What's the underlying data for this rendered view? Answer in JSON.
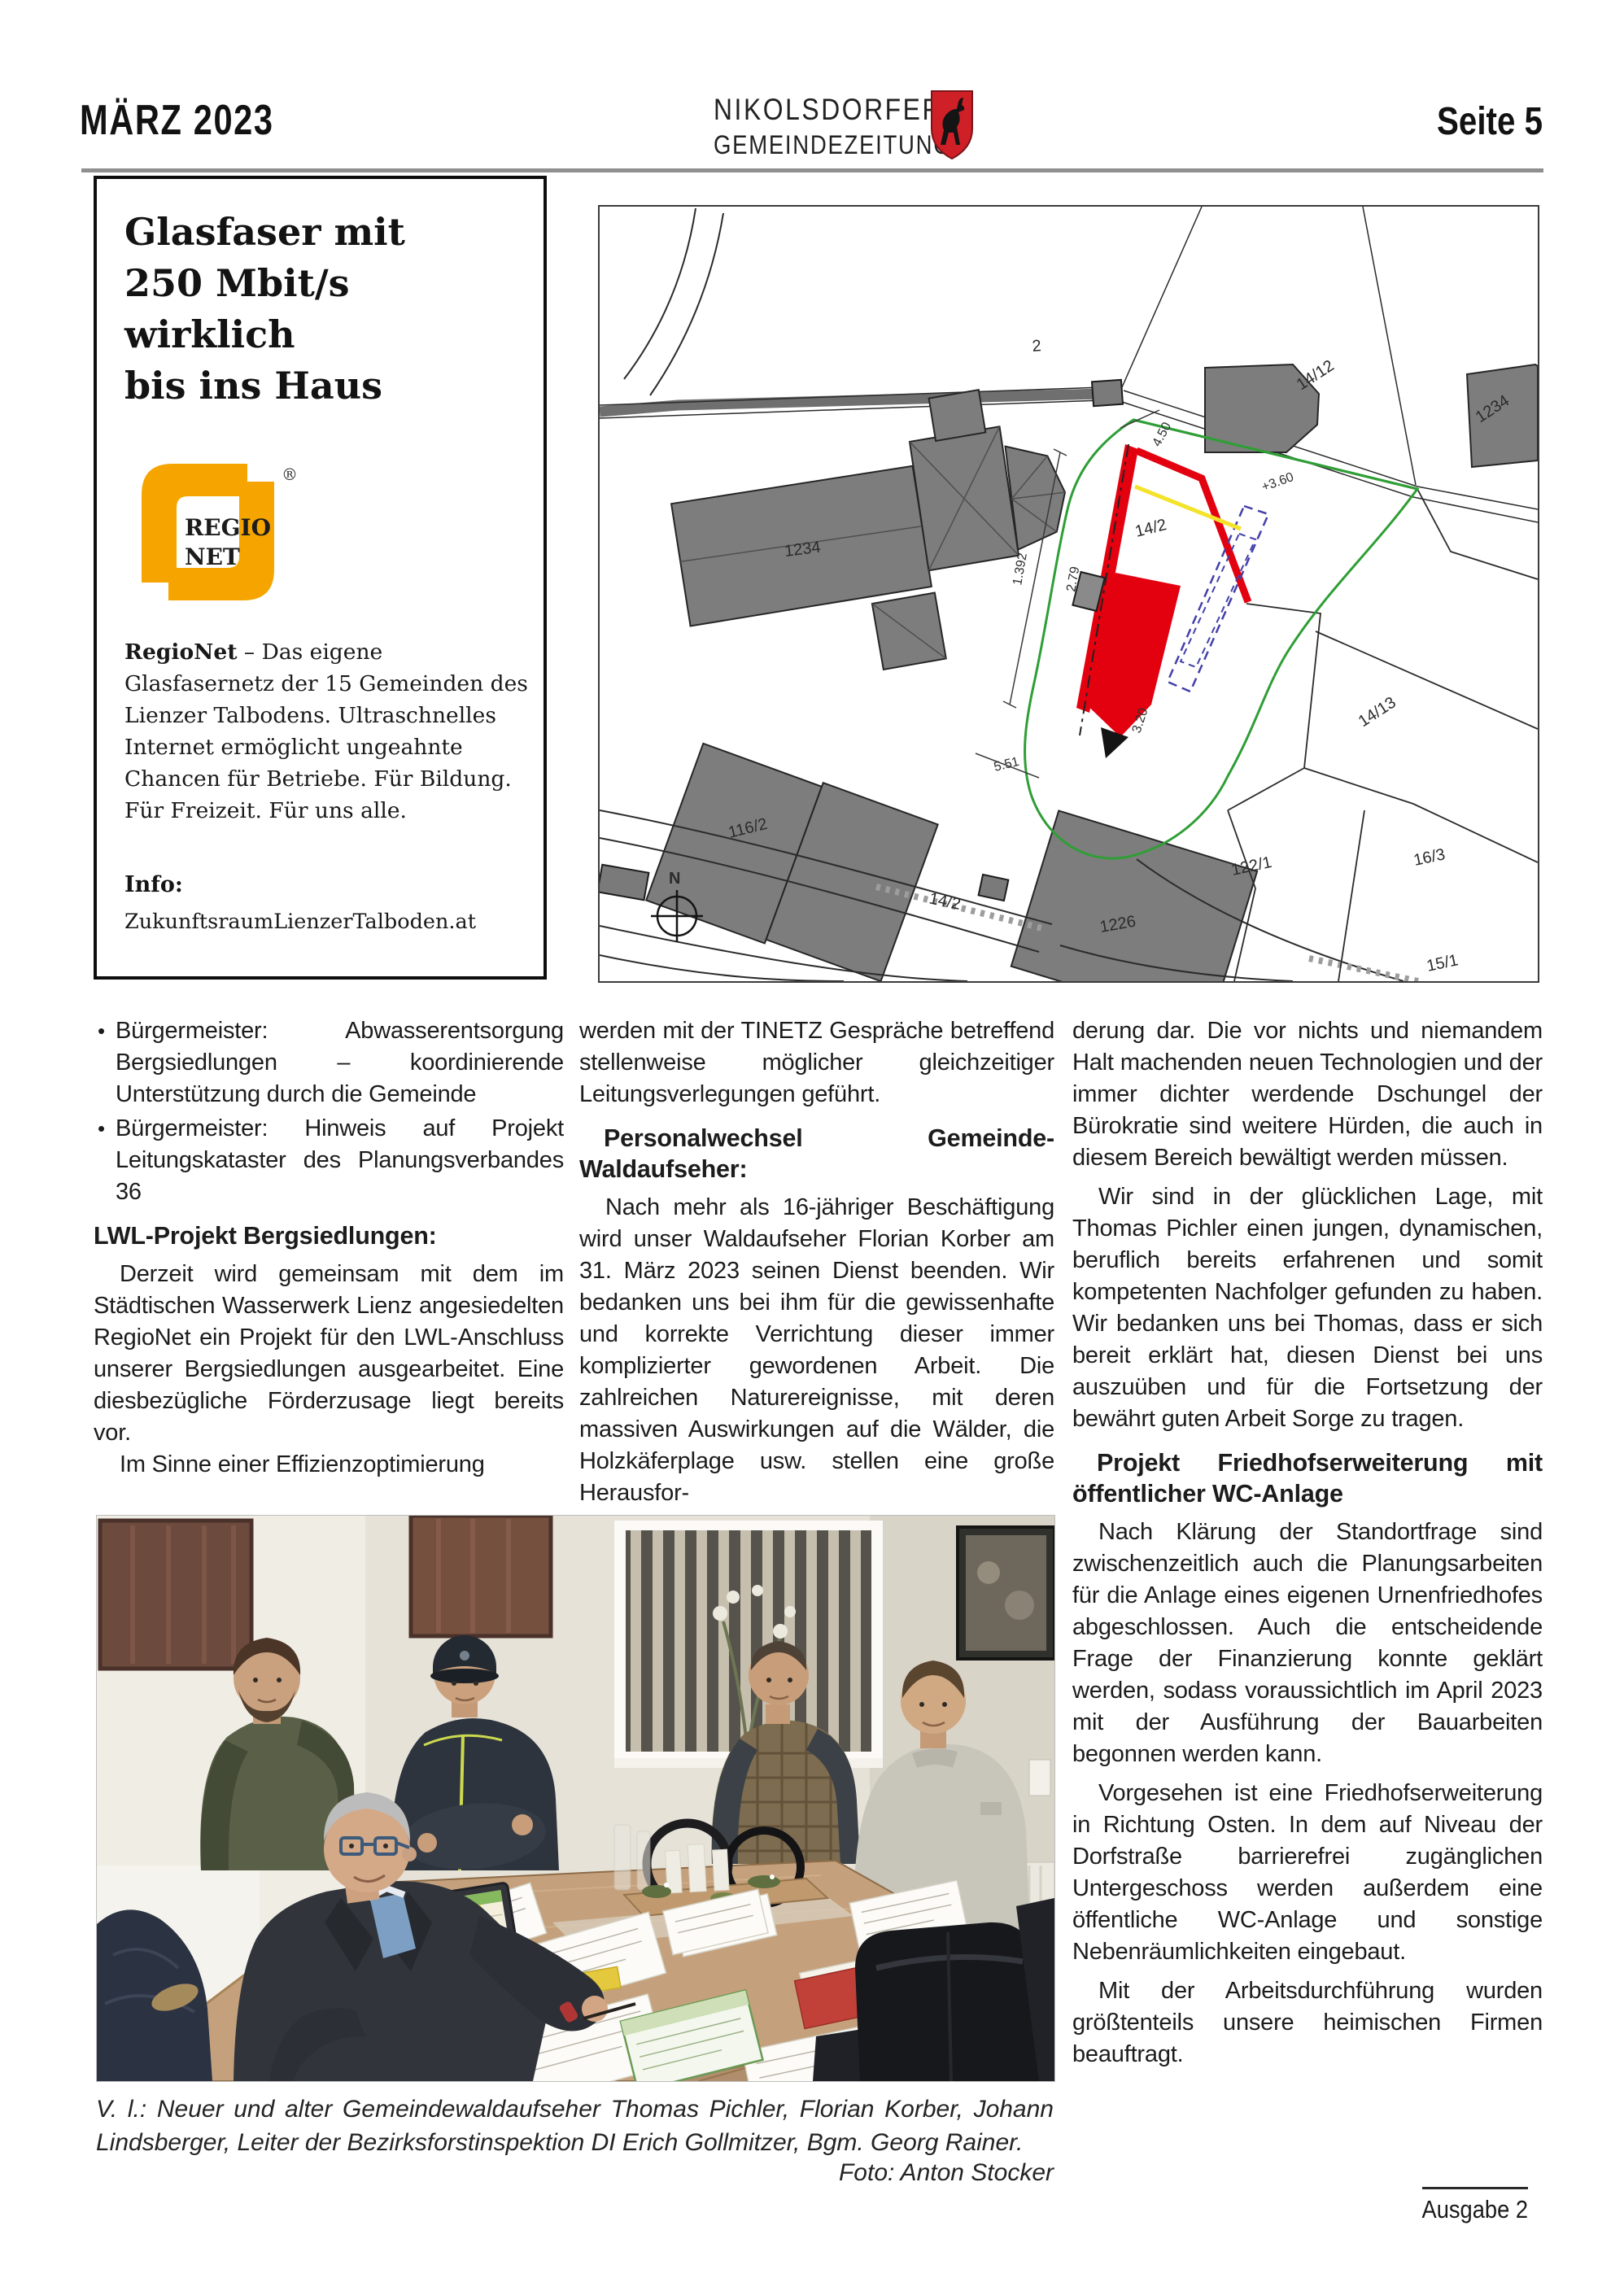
{
  "header": {
    "issue_date": "MÄRZ 2023",
    "masthead_top": "NIKOLSDORFER",
    "masthead_bottom": "GEMEINDEZEITUNG",
    "page_number": "Seite 5"
  },
  "ad": {
    "headline": [
      "Glasfaser mit",
      "250 Mbit/s",
      "wirklich",
      "bis ins Haus"
    ],
    "logo_top": "REGIO",
    "logo_bottom": "NET",
    "registered": "®",
    "body_lead": "RegioNet",
    "body_text": " – Das eigene Glasfasernetz der 15 Gemeinden des Lienzer Talbodens. Ultraschnelles Internet ermöglicht ungeahnte Chancen für Betriebe. Für Bildung. Für Freizeit. Für uns alle.",
    "info_label": "Info:",
    "info_link": "ZukunftsraumLienzerTalboden.at",
    "brand_orange": "#f6a500"
  },
  "map": {
    "labels": {
      "parcel_2": "2",
      "parcel_14_12": "14/12",
      "building_1234_ne": "1234",
      "building_1234_church": "1234",
      "parcel_14_2": "14/2",
      "parcel_14_13": "14/13",
      "building_116_2": "116/2",
      "road_14_2": "14/2",
      "building_1226": "1226",
      "parcel_122_1": "122/1",
      "parcel_16_3": "16/3",
      "parcel_15_1": "15/1",
      "north": "N"
    },
    "dimensions": {
      "d1": "1.392",
      "d2": "4.50",
      "d3": "+3.60",
      "d4": "2.79",
      "d5": "3.20",
      "d6": "5.51"
    },
    "colors": {
      "highlight_red": "#e3000f",
      "boundary_green": "#2f9e36",
      "plan_blue": "#4340a8",
      "marker_yellow": "#f4e32a",
      "building_gray": "#7d7d7d"
    }
  },
  "articles": {
    "bullets": [
      "Bürgermeister: Abwasserentsorgung Bergsiedlungen – koordinierende Unterstützung durch die Gemeinde",
      "Bürgermeister: Hinweis auf Projekt Leitungskataster des Planungsverbandes 36"
    ],
    "heading_lwl": "LWL-Projekt Bergsiedlungen:",
    "lwl_p1": "Derzeit wird gemeinsam mit dem im Städtischen Wasserwerk Lienz angesiedelten RegioNet ein Projekt für den LWL-Anschluss unserer Bergsiedlungen ausgearbeitet. Eine diesbezügliche Förderzusage liegt bereits vor.",
    "lwl_p2": "Im Sinne einer Effizienzoptimierung",
    "lwl_p3": "werden mit der TINETZ Gespräche betreffend stellenweise möglicher gleichzeitiger Leitungsverlegungen geführt.",
    "heading_personal": "Personalwechsel Gemeinde-Waldaufseher:",
    "personal_p1": "Nach mehr als 16-jähriger Beschäftigung wird unser Waldaufseher Florian Korber am 31. März 2023 seinen Dienst beenden. Wir bedanken uns bei ihm für die gewissenhafte und korrekte Verrichtung dieser immer komplizierter gewordenen Arbeit. Die zahlreichen Naturereignisse, mit deren massiven Auswirkungen auf die Wälder, die Holzkäferplage usw. stellen eine große Herausfor-",
    "personal_p2": "derung dar. Die vor nichts und niemandem Halt machenden neuen Technologien und der immer dichter werdende Dschungel der Bürokratie sind weitere Hürden, die auch in diesem Bereich bewältigt werden müssen.",
    "personal_p3": "Wir sind in der glücklichen Lage, mit Thomas Pichler einen jungen, dynamischen, beruflich bereits erfahrenen und somit kompetenten Nachfolger gefunden zu haben. Wir bedanken uns bei Thomas, dass er sich bereit erklärt hat, diesen Dienst bei uns auszuüben und für die Fortsetzung der bewährt guten Arbeit Sorge zu tragen.",
    "heading_friedhof": "Projekt Friedhofserweiterung mit öffentlicher WC-Anlage",
    "friedhof_p1": "Nach Klärung der Standortfrage sind zwischenzeitlich auch die Planungsarbeiten für die Anlage eines eigenen Urnenfriedhofes abgeschlossen. Auch die entscheidende Frage der Finanzierung konnte geklärt werden, sodass voraussichtlich im April 2023 mit der Ausführung der Bauarbeiten begonnen werden kann.",
    "friedhof_p2": "Vorgesehen ist eine Friedhofserweiterung in Richtung Osten. In dem auf Niveau der Dorfstraße barrierefrei zugänglichen Untergeschoss werden außerdem eine öffentliche WC-Anlage und sonstige Nebenräumlichkeiten eingebaut.",
    "friedhof_p3": "Mit der Arbeitsdurchführung wurden größtenteils unsere heimischen Firmen beauftragt."
  },
  "photo_caption": {
    "text": "V. l.: Neuer und alter Gemeindewaldaufseher Thomas Pichler, Florian Korber, Johann Lindsberger, Leiter der Bezirksforstinspektion DI Erich Gollmitzer, Bgm. Georg Rainer.",
    "credit": "Foto: Anton Stocker"
  },
  "footer": {
    "issue": "Ausgabe 2"
  }
}
